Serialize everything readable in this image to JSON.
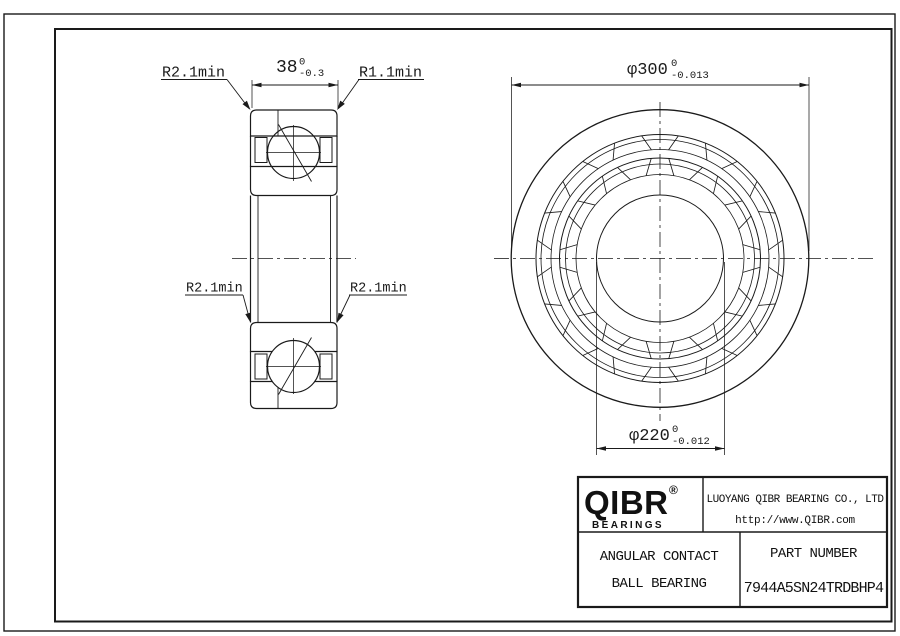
{
  "labels": {
    "radius_top_left": "R2.1min",
    "radius_top_right": "R1.1min",
    "radius_mid_left": "R2.1min",
    "radius_mid_right": "R2.1min"
  },
  "dimensions": {
    "width": {
      "value": "38",
      "upper_tol": "0",
      "lower_tol": "-0.3"
    },
    "outer_diameter": {
      "value": "φ300",
      "upper_tol": "0",
      "lower_tol": "-0.013"
    },
    "bore_diameter": {
      "value": "φ220",
      "upper_tol": "0",
      "lower_tol": "-0.012"
    }
  },
  "title_block": {
    "logo_text": "QIBR",
    "logo_registered": "®",
    "logo_subtext": "BEARINGS",
    "company_name": "LUOYANG QIBR BEARING CO., LTD",
    "website": "http://www.QIBR.com",
    "product_type_line1": "ANGULAR CONTACT",
    "product_type_line2": "BALL BEARING",
    "part_number_label": "PART NUMBER",
    "part_number": "7944A5SN24TRDBHP4"
  },
  "colors": {
    "line": "#1a1a1a",
    "background": "#ffffff"
  }
}
